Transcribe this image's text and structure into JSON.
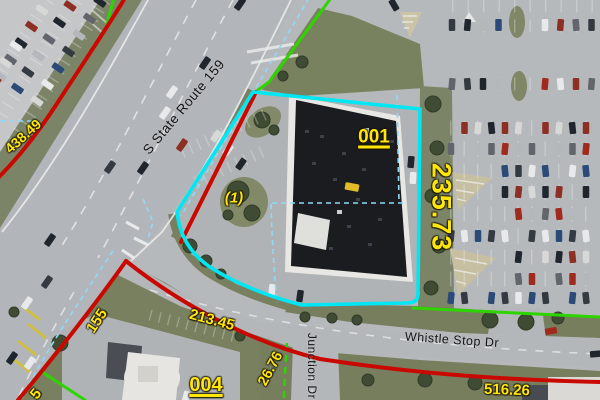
{
  "labels": {
    "route159": {
      "text": "S State Route 159"
    },
    "whistle_stop": {
      "text": "Whistle Stop Dr"
    },
    "junction": {
      "text": "Junction Dr"
    },
    "parcel_001": {
      "text": "001"
    },
    "parcel_004": {
      "text": "004"
    },
    "sub_parcel_1": {
      "text": "(1)"
    },
    "dim_438_49": {
      "text": "438.49"
    },
    "dim_235_73": {
      "text": "235.73"
    },
    "dim_155": {
      "text": "155"
    },
    "dim_213_45": {
      "text": "213.45"
    },
    "dim_26_76": {
      "text": "26.76"
    },
    "dim_516_26": {
      "text": "516.26"
    },
    "dim_partial_5": {
      "text": "5"
    }
  },
  "colors": {
    "parcel_boundary_cyan": "#00e6f2",
    "lot_line_red": "#c90900",
    "lot_line_green": "#2ed400",
    "survey_line_cyan": "#8fd9f7",
    "label_yellow": "#ffe60a",
    "road_label_black": "#141414"
  },
  "scenery": {
    "car_colors": [
      "#20262e",
      "#e8e9ea",
      "#b4b7bb",
      "#8e2f23",
      "#2c4a78",
      "#62666c",
      "#d8d9d7",
      "#343a42",
      "#a02a1e"
    ]
  }
}
